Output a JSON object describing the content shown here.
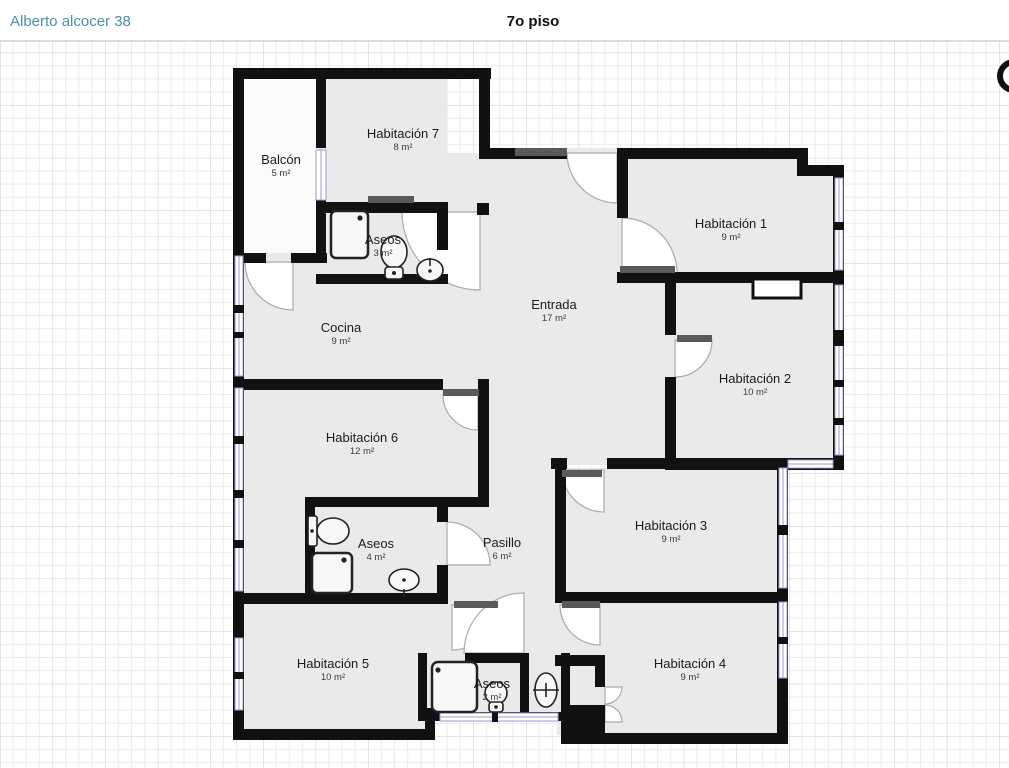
{
  "header": {
    "project_title": "Alberto alcocer 38",
    "floor_title": "7o piso"
  },
  "plan": {
    "rooms": [
      {
        "name": "Balcón",
        "area": "5 m²"
      },
      {
        "name": "Habitación 7",
        "area": "8 m²"
      },
      {
        "name": "Aseos",
        "area": "3 m²",
        "fixtures": [
          "shower-icon",
          "toilet-icon",
          "sink-icon"
        ]
      },
      {
        "name": "Cocina",
        "area": "9 m²"
      },
      {
        "name": "Entrada",
        "area": "17 m²"
      },
      {
        "name": "Habitación 1",
        "area": "9 m²"
      },
      {
        "name": "Habitación 2",
        "area": "10 m²"
      },
      {
        "name": "Habitación 6",
        "area": "12 m²"
      },
      {
        "name": "Aseos",
        "area": "4 m²",
        "fixtures": [
          "toilet-icon",
          "shower-icon",
          "sink-icon"
        ]
      },
      {
        "name": "Pasillo",
        "area": "6 m²"
      },
      {
        "name": "Habitación 3",
        "area": "9 m²"
      },
      {
        "name": "Habitación 5",
        "area": "10 m²"
      },
      {
        "name": "Aseos",
        "area": "2 m²",
        "fixtures": [
          "shower-icon",
          "toilet-icon",
          "sink-icon"
        ]
      },
      {
        "name": "Habitación 4",
        "area": "9 m²"
      }
    ],
    "icons": {
      "compass": "compass-icon"
    },
    "colors": {
      "accent_title": "#4b8fa9",
      "wall": "#111111",
      "floor": "#eaeaea",
      "balcony_floor": "#fbfbfb",
      "window_frame": "#9b9bd0",
      "grid_minor": "#ececec",
      "grid_major": "#c9c9c9",
      "door_leaf": "#5a5a5a"
    }
  }
}
